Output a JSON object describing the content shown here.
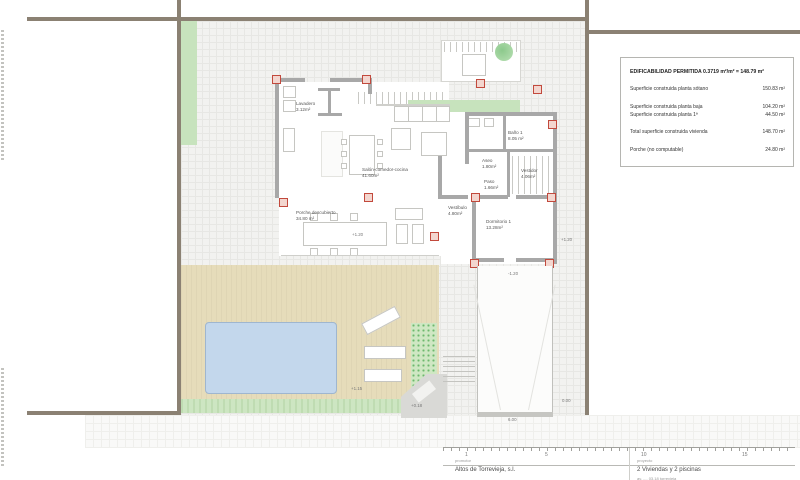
{
  "info_box": {
    "title": "EDIFICABILIDAD PERMITIDA 0.3719 m²/m² = 148.79 m²",
    "rows": [
      {
        "label": "Superficie construida planta sótano",
        "value": "150.83 m²"
      },
      {
        "label": "Superficie construida planta baja",
        "value": "104.20 m²"
      },
      {
        "label": "Superficie construida planta 1ª",
        "value": "44.50 m²"
      },
      {
        "label": "Total superficie construida vivienda",
        "value": "148.70 m²"
      },
      {
        "label": "Porche (no computable)",
        "value": "24.80 m²"
      }
    ]
  },
  "rooms": [
    {
      "name": "Lavadero",
      "area": "3.12m²"
    },
    {
      "name": "Salón-comedor-cocina",
      "area": "41.60m²"
    },
    {
      "name": "Porche descubierto",
      "area": "34.80 m²"
    },
    {
      "name": "Vestíbulo",
      "area": "4.80m²"
    },
    {
      "name": "Paso",
      "area": "1.66m²"
    },
    {
      "name": "Aseo",
      "area": "1.80m²"
    },
    {
      "name": "Baño 1",
      "area": "8.05 m²"
    },
    {
      "name": "Vestidor",
      "area": "4.06m²"
    },
    {
      "name": "Dormitorio 1",
      "area": "13.28m²"
    }
  ],
  "annotations": [
    "+1.20",
    "+1.20",
    "-1.20",
    "+1.15",
    "+0.18",
    "0.00",
    "6.00"
  ],
  "scale_bar": {
    "ticks": [
      "1",
      "5",
      "10",
      "15"
    ]
  },
  "title_block": {
    "promoter_label": "promotor",
    "promoter": "Altos de Torrevieja, s.l.",
    "project_label": "proyecto",
    "project": "2 Viviendas y 2 piscinas",
    "project_address": "av. ..., 03.18 torrevieja"
  },
  "colors": {
    "boundary_wall": "#8b8173",
    "house_wall": "#a8a8a8",
    "deck": "#e6dcba",
    "pool": "#bdd2e9",
    "green": "#c7e3bd",
    "pillar_red": "#c2493c"
  }
}
